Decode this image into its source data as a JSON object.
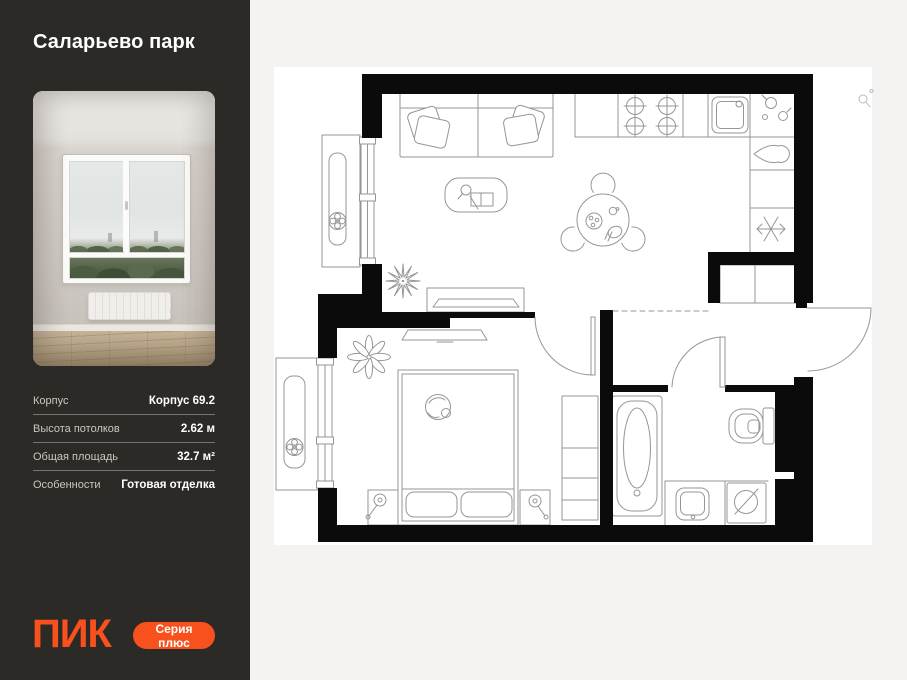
{
  "page": {
    "bg": "#F4F3F1"
  },
  "sidebar": {
    "bg": "#2B2A26",
    "title": "Саларьево парк",
    "details": {
      "rows": [
        {
          "label": "Корпус",
          "value": "Корпус 69.2"
        },
        {
          "label": "Высота потолков",
          "value": "2.62 м"
        },
        {
          "label": "Общая площадь",
          "value": "32.7 м²"
        },
        {
          "label": "Особенности",
          "value": "Готовая отделка"
        }
      ]
    },
    "logo": "ПИК",
    "series_button": "Серия плюс",
    "accent_color": "#F8511D"
  },
  "floor_plan": {
    "paper_color": "#FFFFFF",
    "wall_color": "#0B0B0B",
    "line_color": "#969696",
    "rooms": [
      {
        "name": "living-kitchen"
      },
      {
        "name": "bedroom"
      },
      {
        "name": "bathroom"
      },
      {
        "name": "hallway"
      },
      {
        "name": "balcony-top"
      },
      {
        "name": "balcony-bottom"
      }
    ],
    "furniture_icons": [
      "sofa",
      "sofa-pillows",
      "coffee-table",
      "magnifier-icon",
      "book-icon",
      "plant-icon",
      "tv-console",
      "dining-table",
      "chair-icon",
      "stove-icon",
      "kitchen-sink-icon",
      "kettle-icon",
      "fridge-snowflake-icon",
      "closet",
      "bed",
      "cat-icon",
      "nightstand",
      "lamp-icon",
      "wardrobe",
      "bathtub-icon",
      "toilet-icon",
      "washbasin-icon",
      "washing-machine-icon",
      "radiator-fan-icon",
      "door-arc",
      "entrance-door-arc"
    ]
  }
}
